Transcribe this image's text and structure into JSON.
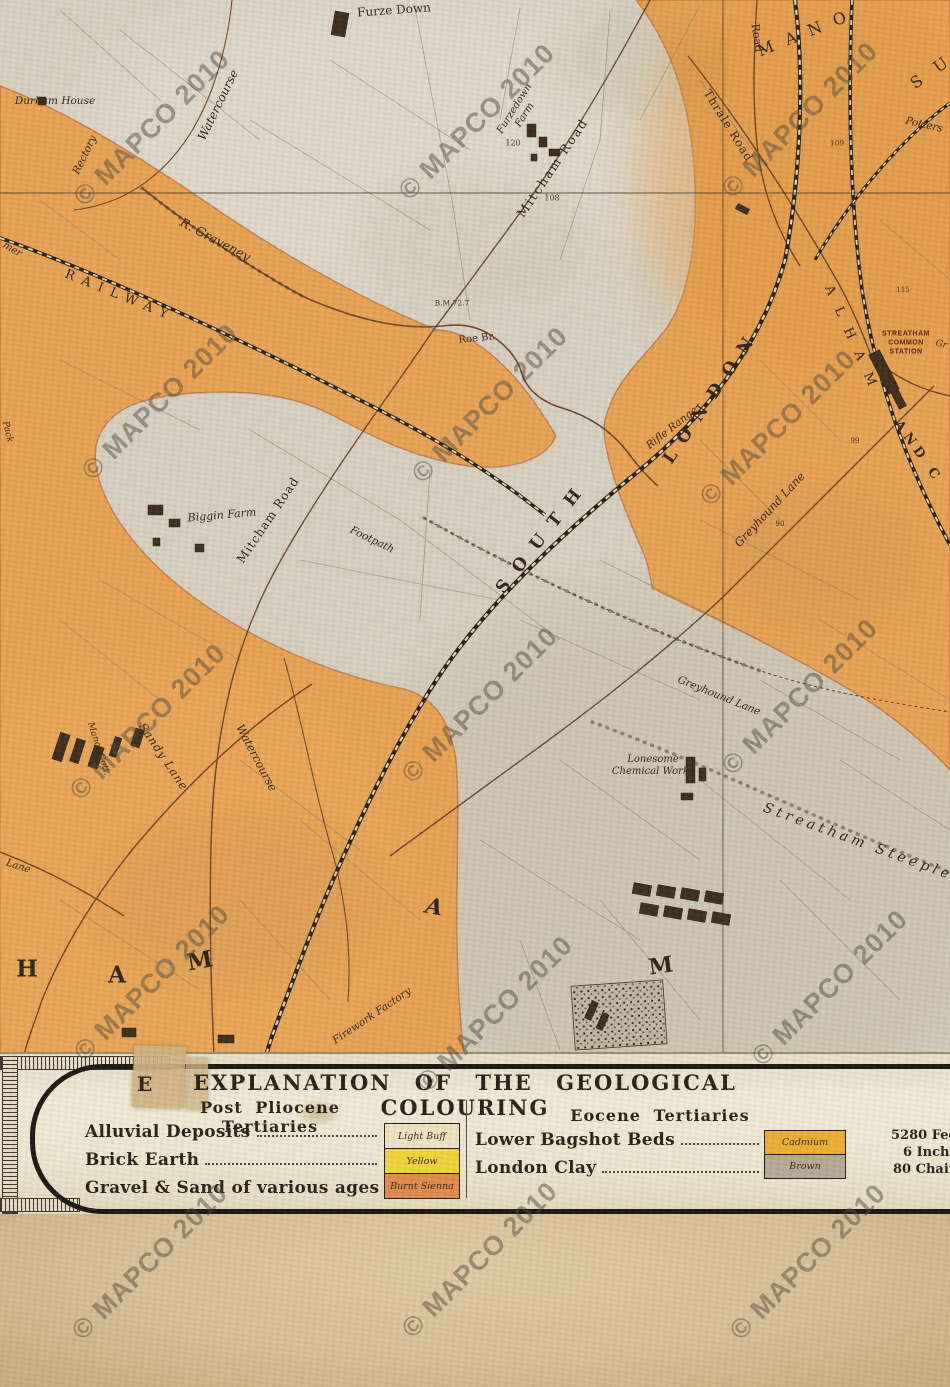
{
  "watermark": {
    "text": "© MAPCO 2010",
    "positions": [
      [
        152,
        128
      ],
      [
        477,
        122
      ],
      [
        800,
        120
      ],
      [
        160,
        402
      ],
      [
        490,
        405
      ],
      [
        778,
        428
      ],
      [
        148,
        722
      ],
      [
        480,
        705
      ],
      [
        800,
        697
      ],
      [
        152,
        983
      ],
      [
        495,
        1014
      ],
      [
        830,
        988
      ],
      [
        150,
        1262
      ],
      [
        480,
        1260
      ],
      [
        808,
        1262
      ]
    ]
  },
  "map": {
    "colors": {
      "gravel_orange": "#e7a153",
      "alluvium_grey": "#d6cfc0",
      "railway_ink": "#241c12",
      "road_ink": "#5d3a20",
      "boundary_ink": "#a24a20"
    },
    "labels": [
      {
        "t": "Furze Down",
        "x": 394,
        "y": 10,
        "r": -4,
        "s": 12,
        "c": ""
      },
      {
        "t": "Durham House",
        "x": 55,
        "y": 101,
        "r": 0,
        "s": 10.5,
        "c": "it"
      },
      {
        "t": "Rectory",
        "x": 85,
        "y": 155,
        "r": -64,
        "s": 10.5,
        "c": "it"
      },
      {
        "t": "Watercourse",
        "x": 218,
        "y": 105,
        "r": -64,
        "s": 12,
        "c": "it"
      },
      {
        "t": "R. Graveney",
        "x": 215,
        "y": 240,
        "r": 28,
        "s": 12.5,
        "c": "it"
      },
      {
        "t": "RAILWAY",
        "x": 120,
        "y": 296,
        "r": 22,
        "s": 13,
        "ls": 8,
        "c": ""
      },
      {
        "t": "Furzedown\nFarm",
        "x": 520,
        "y": 112,
        "r": -58,
        "s": 10,
        "c": "it"
      },
      {
        "t": "120",
        "x": 513,
        "y": 143,
        "r": 0,
        "s": 8,
        "c": "num"
      },
      {
        "t": "108",
        "x": 552,
        "y": 198,
        "r": 0,
        "s": 8,
        "c": "num"
      },
      {
        "t": "Mitcham Road",
        "x": 553,
        "y": 168,
        "r": -56,
        "s": 12.5,
        "ls": 2,
        "c": ""
      },
      {
        "t": "Thrale Road",
        "x": 728,
        "y": 126,
        "r": 58,
        "s": 11.5,
        "ls": 1,
        "c": ""
      },
      {
        "t": "Road",
        "x": 756,
        "y": 38,
        "r": 82,
        "s": 11,
        "c": ""
      },
      {
        "t": "M A N O",
        "x": 804,
        "y": 34,
        "r": -22,
        "s": 16,
        "ls": 4,
        "c": ""
      },
      {
        "t": "S U",
        "x": 932,
        "y": 72,
        "r": -35,
        "s": 16,
        "ls": 6,
        "c": ""
      },
      {
        "t": "Potters",
        "x": 924,
        "y": 125,
        "r": 13,
        "s": 10.5,
        "c": "it"
      },
      {
        "t": "109",
        "x": 837,
        "y": 144,
        "r": 0,
        "s": 7.5,
        "c": "num"
      },
      {
        "t": "115",
        "x": 903,
        "y": 290,
        "r": 0,
        "s": 7,
        "c": "num"
      },
      {
        "t": "STREATHAM\nCOMMON\nSTATION",
        "x": 906,
        "y": 343,
        "r": 0,
        "s": 7,
        "c": "stn"
      },
      {
        "t": "A L H A M",
        "x": 851,
        "y": 338,
        "r": 66,
        "s": 13,
        "ls": 5,
        "c": ""
      },
      {
        "t": "AND C",
        "x": 918,
        "y": 452,
        "r": 55,
        "s": 13,
        "ls": 5,
        "c": "b"
      },
      {
        "t": "LONDON",
        "x": 712,
        "y": 396,
        "r": -56,
        "s": 17,
        "ls": 12,
        "c": "b"
      },
      {
        "t": "SOUTH",
        "x": 543,
        "y": 536,
        "r": -52,
        "s": 17,
        "ls": 14,
        "c": "b"
      },
      {
        "t": "Rifle Range",
        "x": 672,
        "y": 428,
        "r": -38,
        "s": 10.5,
        "c": "it"
      },
      {
        "t": "B.M.72.7",
        "x": 452,
        "y": 304,
        "r": 0,
        "s": 7.5,
        "c": "num"
      },
      {
        "t": "Roe Br.",
        "x": 477,
        "y": 339,
        "r": -6,
        "s": 10,
        "c": ""
      },
      {
        "t": "Greyhound Lane",
        "x": 770,
        "y": 510,
        "r": -47,
        "s": 11.5,
        "c": "it"
      },
      {
        "t": "99",
        "x": 855,
        "y": 441,
        "r": 0,
        "s": 7,
        "c": "num"
      },
      {
        "t": "90",
        "x": 780,
        "y": 524,
        "r": 0,
        "s": 7,
        "c": "num"
      },
      {
        "t": "Biggin Farm",
        "x": 222,
        "y": 516,
        "r": -5,
        "s": 11,
        "c": "it"
      },
      {
        "t": "Mitcham Road",
        "x": 268,
        "y": 520,
        "r": -56,
        "s": 12,
        "ls": 1,
        "c": ""
      },
      {
        "t": "Footpath",
        "x": 372,
        "y": 540,
        "r": 26,
        "s": 10.5,
        "c": "it"
      },
      {
        "t": "Sandy Lane",
        "x": 163,
        "y": 757,
        "r": 56,
        "s": 11.5,
        "ls": 1,
        "c": "it"
      },
      {
        "t": "Watercourse",
        "x": 256,
        "y": 758,
        "r": 62,
        "s": 11.5,
        "c": "it"
      },
      {
        "t": "Manor Cott.",
        "x": 98,
        "y": 749,
        "r": 72,
        "s": 9,
        "c": "it"
      },
      {
        "t": "Lane",
        "x": 18,
        "y": 867,
        "r": 18,
        "s": 10,
        "c": "it"
      },
      {
        "t": "H",
        "x": 27,
        "y": 969,
        "r": 0,
        "s": 23,
        "c": "b"
      },
      {
        "t": "A",
        "x": 117,
        "y": 975,
        "r": 0,
        "s": 23,
        "c": "b"
      },
      {
        "t": "M",
        "x": 200,
        "y": 961,
        "r": -10,
        "s": 23,
        "c": "b"
      },
      {
        "t": "A",
        "x": 434,
        "y": 908,
        "r": 10,
        "s": 22,
        "c": "it b"
      },
      {
        "t": "M",
        "x": 661,
        "y": 967,
        "r": -8,
        "s": 22,
        "c": "b"
      },
      {
        "t": "Firework Factory",
        "x": 372,
        "y": 1016,
        "r": -34,
        "s": 10.5,
        "c": "it"
      },
      {
        "t": "Lonesome\nChemical Works",
        "x": 653,
        "y": 766,
        "r": 0,
        "s": 10,
        "c": "it"
      },
      {
        "t": "Greyhound Lane",
        "x": 719,
        "y": 696,
        "r": 22,
        "s": 10.5,
        "c": "it"
      },
      {
        "t": "Streatham Steeple",
        "x": 858,
        "y": 842,
        "r": 20,
        "s": 14,
        "ls": 4,
        "c": "it"
      },
      {
        "t": "mer",
        "x": 12,
        "y": 250,
        "r": 30,
        "s": 10,
        "c": "it"
      },
      {
        "t": "Pack",
        "x": 7,
        "y": 432,
        "r": 76,
        "s": 9,
        "c": "it"
      },
      {
        "t": "Gr",
        "x": 941,
        "y": 345,
        "r": 15,
        "s": 9,
        "c": "it"
      }
    ],
    "buildings": [
      [
        333,
        12,
        14,
        24,
        10
      ],
      [
        38,
        97,
        8,
        8,
        0
      ],
      [
        527,
        124,
        9,
        13,
        0
      ],
      [
        539,
        137,
        8,
        10,
        0
      ],
      [
        549,
        149,
        11,
        7,
        0
      ],
      [
        531,
        154,
        6,
        7,
        0
      ],
      [
        736,
        206,
        13,
        6,
        28
      ],
      [
        862,
        366,
        44,
        12,
        63
      ],
      [
        884,
        392,
        26,
        8,
        63
      ],
      [
        148,
        505,
        15,
        10,
        0
      ],
      [
        169,
        519,
        11,
        8,
        0
      ],
      [
        195,
        544,
        9,
        8,
        0
      ],
      [
        153,
        538,
        7,
        8,
        0
      ],
      [
        56,
        733,
        10,
        28,
        18
      ],
      [
        73,
        739,
        9,
        24,
        18
      ],
      [
        91,
        746,
        10,
        22,
        18
      ],
      [
        112,
        737,
        7,
        20,
        18
      ],
      [
        133,
        729,
        9,
        18,
        18
      ],
      [
        686,
        757,
        9,
        26,
        0
      ],
      [
        699,
        768,
        7,
        13,
        0
      ],
      [
        681,
        793,
        12,
        7,
        0
      ],
      [
        633,
        884,
        18,
        11,
        10
      ],
      [
        657,
        886,
        18,
        11,
        10
      ],
      [
        681,
        889,
        18,
        11,
        10
      ],
      [
        705,
        892,
        18,
        11,
        10
      ],
      [
        640,
        904,
        18,
        11,
        10
      ],
      [
        664,
        907,
        18,
        11,
        10
      ],
      [
        688,
        910,
        18,
        11,
        10
      ],
      [
        712,
        913,
        18,
        11,
        10
      ],
      [
        588,
        1001,
        7,
        19,
        24
      ],
      [
        599,
        1013,
        7,
        17,
        24
      ],
      [
        122,
        1028,
        14,
        9,
        0
      ],
      [
        218,
        1035,
        16,
        8,
        0
      ]
    ]
  },
  "legend": {
    "stray_letter": "E",
    "title": "EXPLANATION OF THE GEOLOGICAL COLOURING",
    "left": {
      "header": "Post Pliocene Tertiaries",
      "rows": [
        {
          "label": "Alluvial Deposits",
          "swatch": "Light Buff",
          "color": "#f1e3c0"
        },
        {
          "label": "Brick Earth",
          "swatch": "Yellow",
          "color": "#f0d435"
        },
        {
          "label": "Gravel & Sand of various ages",
          "swatch": "Burnt Sienna",
          "color": "#e08a4a"
        }
      ]
    },
    "right": {
      "header": "Eocene Tertiaries",
      "rows": [
        {
          "label": "Lower Bagshot Beds",
          "swatch": "Cadmium",
          "color": "#eead2e"
        },
        {
          "label": "London Clay",
          "swatch": "Brown",
          "color": "#b3a896"
        }
      ]
    },
    "scale_notes": [
      "5280 Feet",
      "6 Inches",
      "80 Chains"
    ]
  }
}
